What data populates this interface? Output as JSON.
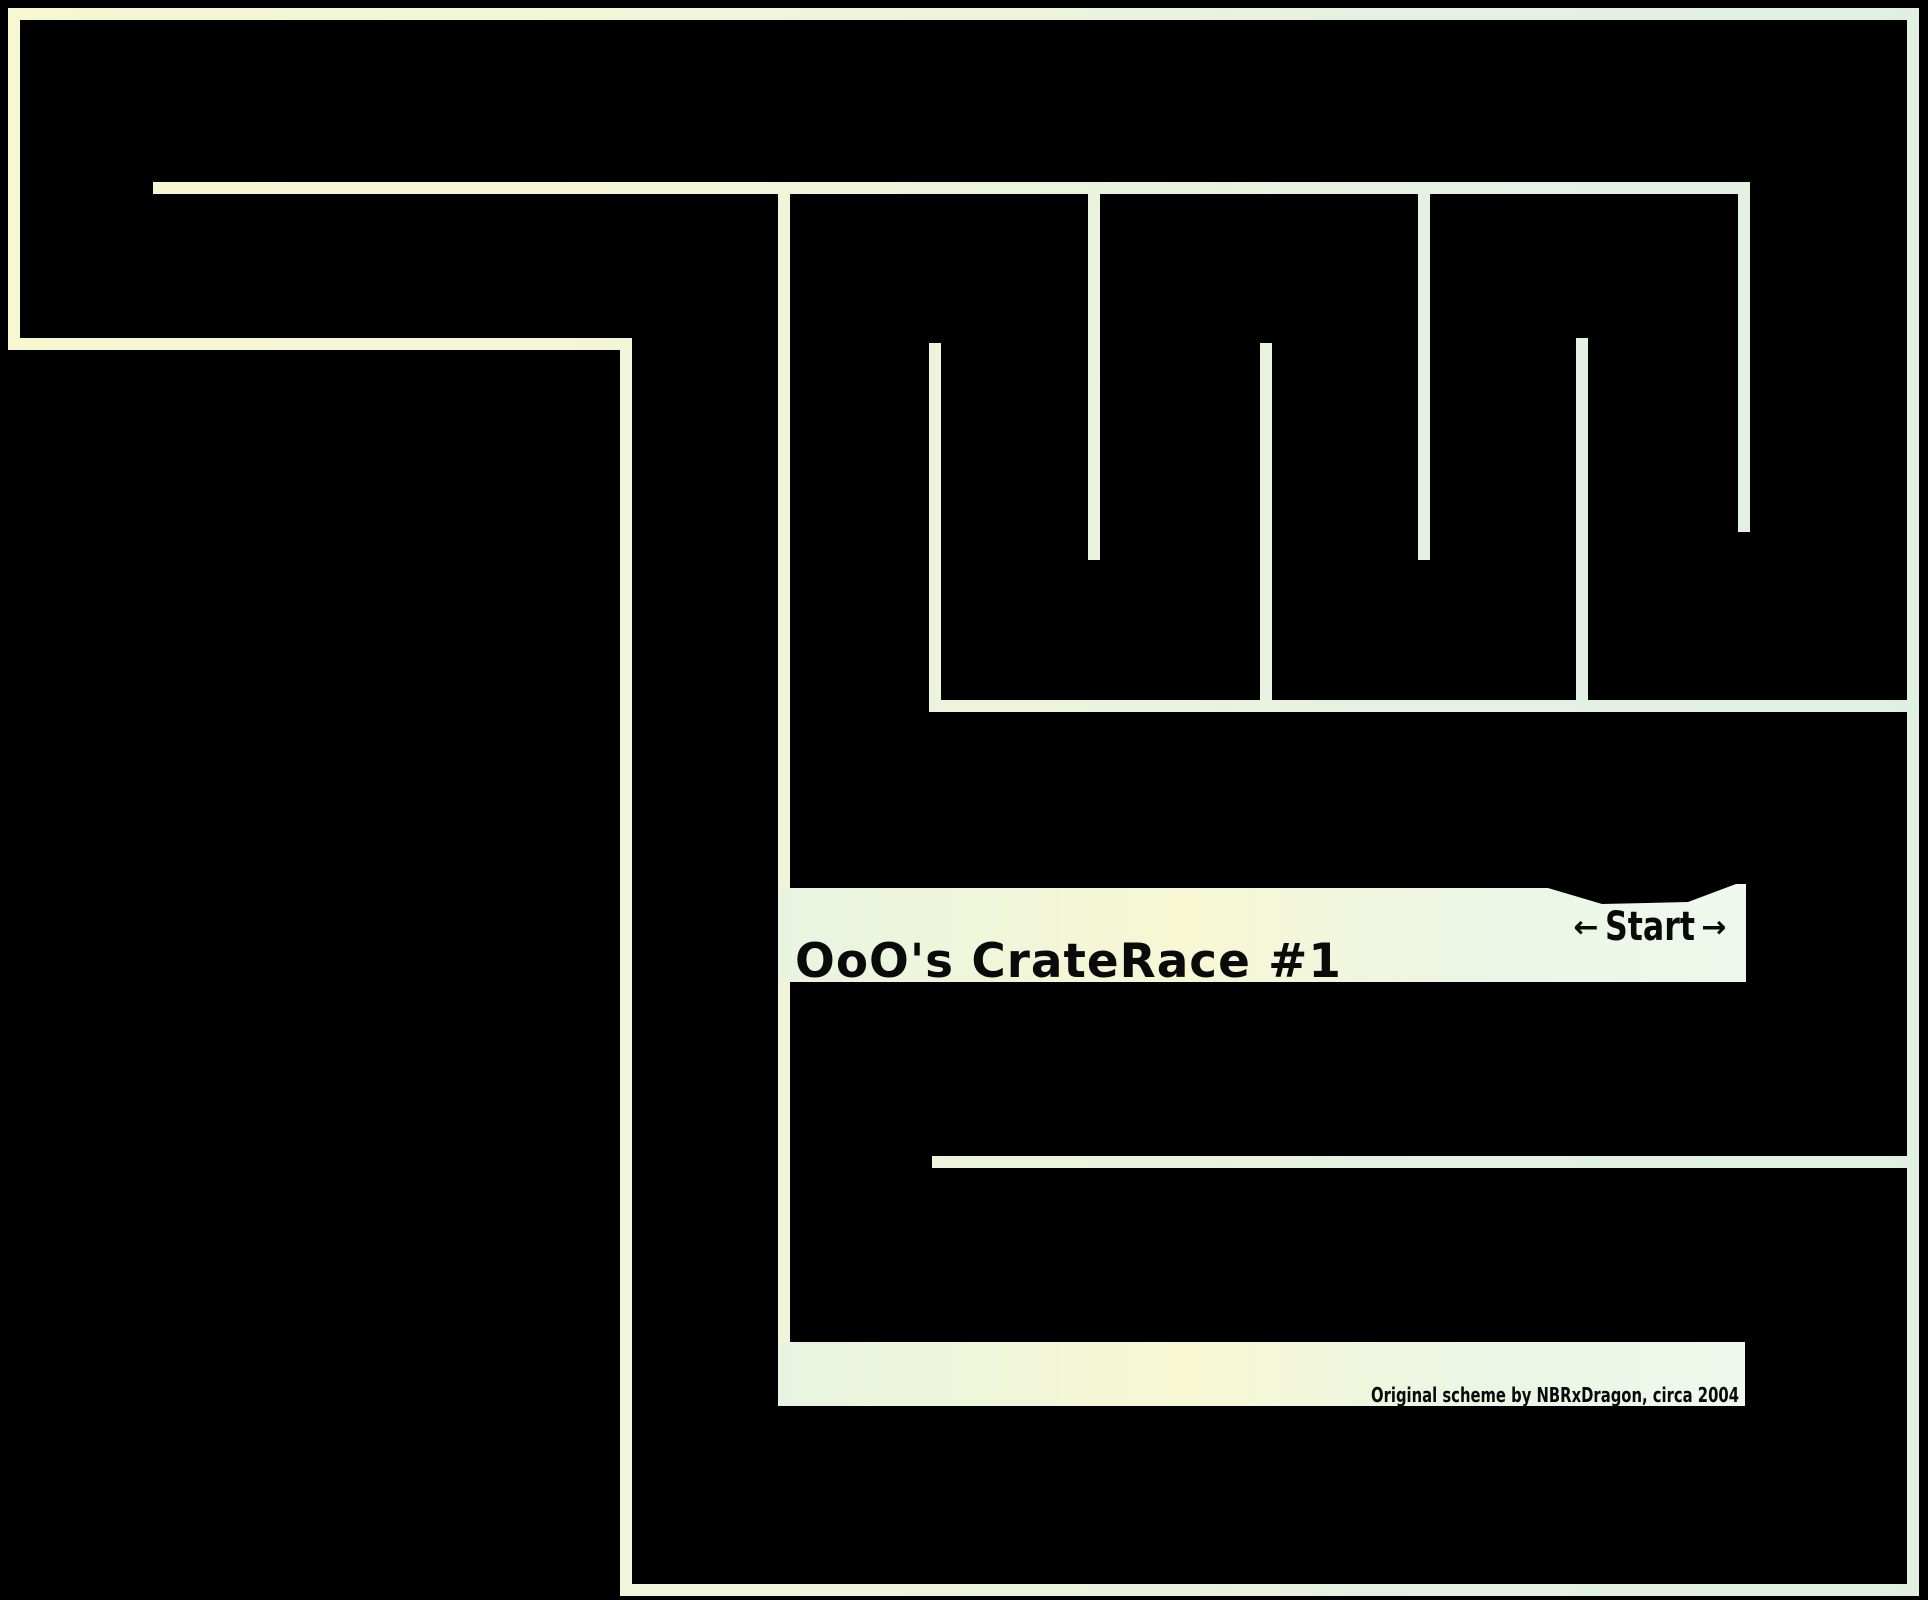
{
  "palette": {
    "wall_cream": "#f7f7d0",
    "wall_cream2": "#f3f5d8",
    "wall_mint": "#e4f2e2",
    "wall_mint2": "#dff0e1",
    "band_left": "#e9f4e0",
    "band_mid": "#f7f7d3",
    "band_right": "#ecf6e5",
    "band_end": "#eef8ec",
    "ink": "#0a0a0a"
  },
  "track": {
    "title": "OoO's CrateRace #1",
    "start": {
      "left_arrow": "←",
      "label": "Start",
      "right_arrow": "→"
    },
    "attribution": "Original scheme by NBRxDragon, circa 2004"
  }
}
